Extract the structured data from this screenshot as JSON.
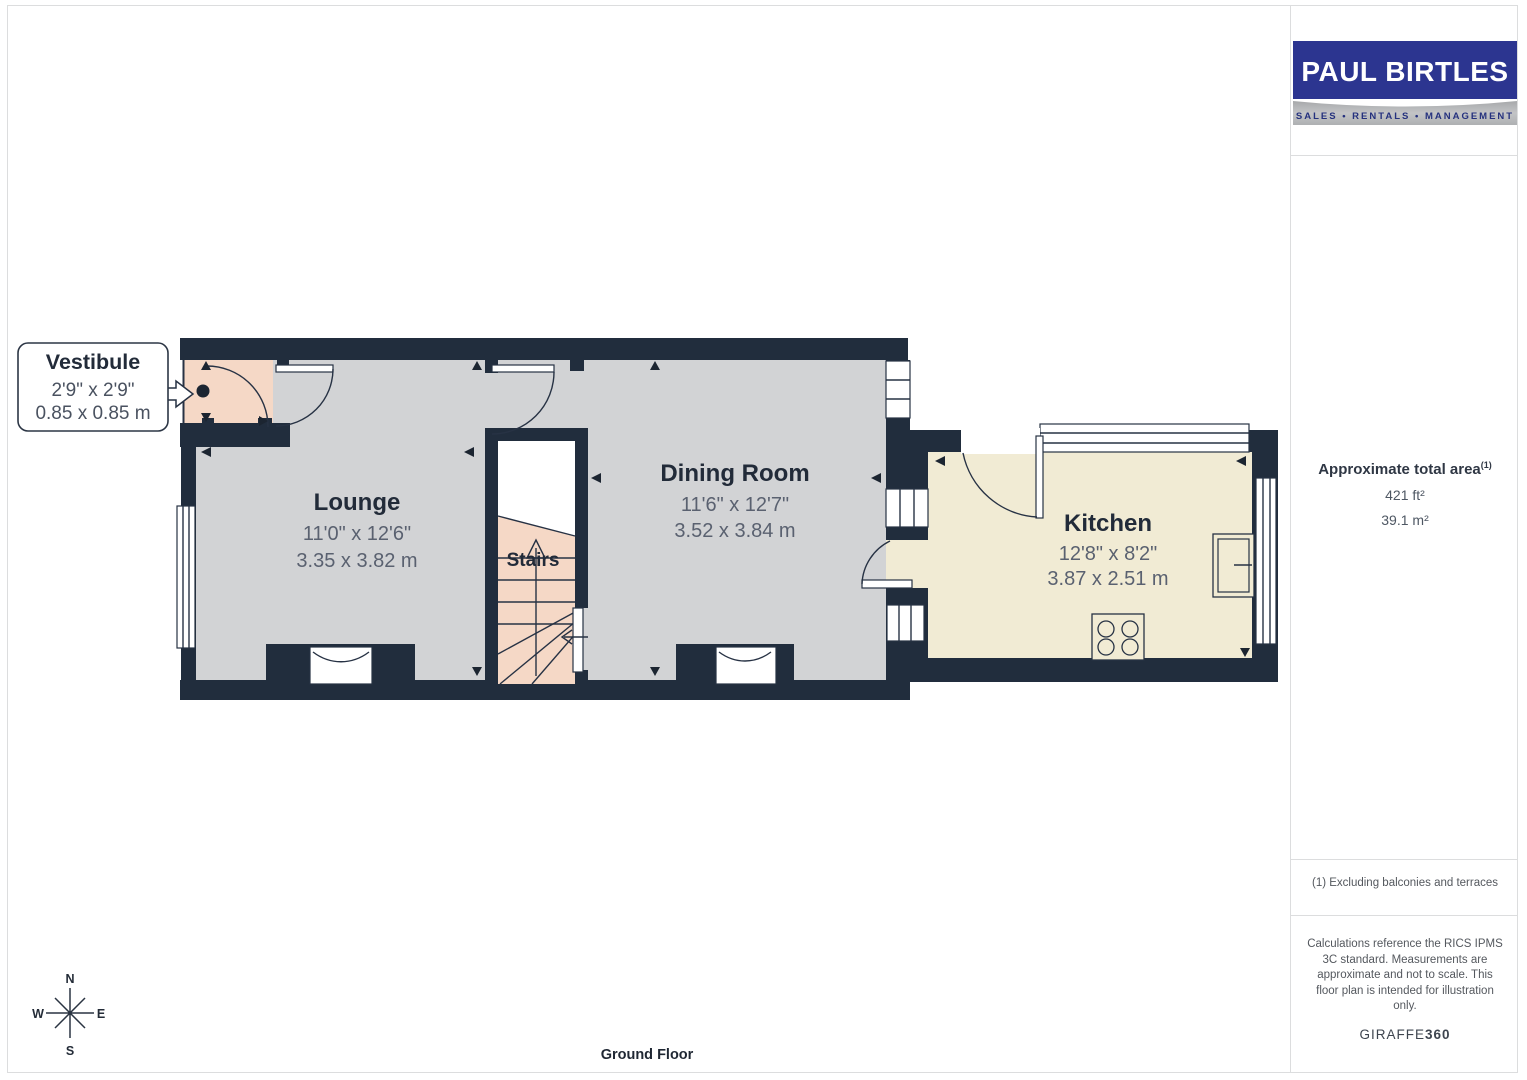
{
  "logo": {
    "title": "PAUL BIRTLES",
    "subtitle": "SALES • RENTALS • MANAGEMENT"
  },
  "sidebar": {
    "area_title": "Approximate total area",
    "area_sup": "(1)",
    "area_imperial": "421 ft²",
    "area_metric": "39.1 m²",
    "footnote": "(1) Excluding balconies and terraces",
    "disclaimer": "Calculations reference the RICS IPMS 3C standard. Measurements are approximate and not to scale. This floor plan is intended for illustration only.",
    "brand_name": "GIRAFFE",
    "brand_suffix": "360"
  },
  "floor_label": "Ground Floor",
  "compass": {
    "north": "N",
    "south": "S",
    "east": "E",
    "west": "W"
  },
  "rooms": {
    "vestibule": {
      "name": "Vestibule",
      "imperial": "2'9\" x 2'9\"",
      "metric": "0.85 x 0.85 m"
    },
    "lounge": {
      "name": "Lounge",
      "imperial": "11'0\" x 12'6\"",
      "metric": "3.35 x 3.82 m"
    },
    "stairs": {
      "name": "Stairs"
    },
    "dining": {
      "name": "Dining Room",
      "imperial": "11'6\" x 12'7\"",
      "metric": "3.52 x 3.84 m"
    },
    "kitchen": {
      "name": "Kitchen",
      "imperial": "12'8\" x 8'2\"",
      "metric": "3.87 x 2.51 m"
    }
  },
  "colors": {
    "wall": "#212d3d",
    "floor-gray": "#d2d3d5",
    "floor-pink": "#f5d8c6",
    "floor-cream": "#f1ebd4",
    "line-dark": "#273244",
    "logo-blue": "#2c3590",
    "logo-band-text": "#25317e",
    "page-line": "#dcddde"
  }
}
